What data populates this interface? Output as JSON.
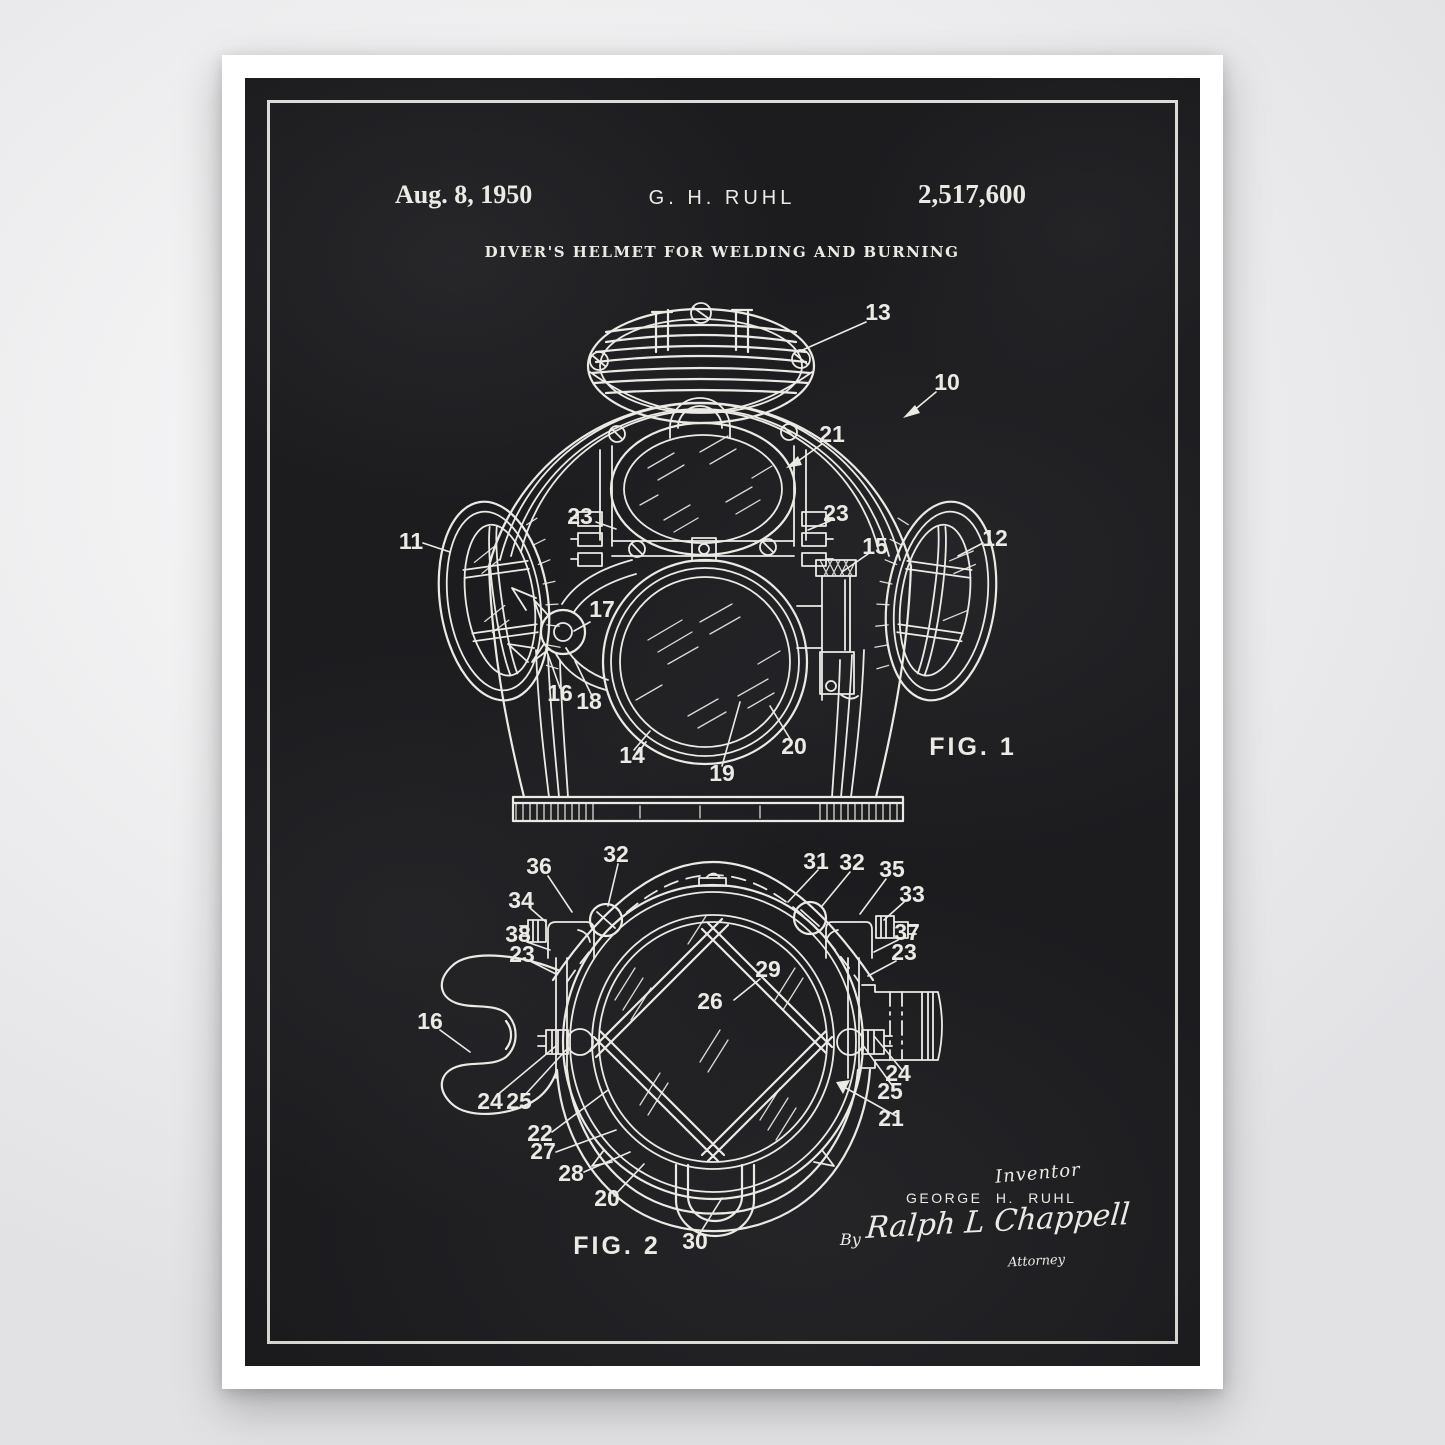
{
  "poster": {
    "colors": {
      "board": "#1c1c1f",
      "chalk_line": "#eceae5",
      "paper": "#ffffff",
      "page_background": "#ececee"
    },
    "header": {
      "date": "Aug. 8, 1950",
      "inventor_initials": "G. H. RUHL",
      "patent_number": "2,517,600",
      "title": "DIVER'S HELMET FOR WELDING AND BURNING"
    },
    "figure1": {
      "caption": "FIG. 1",
      "callouts": [
        {
          "label": "13"
        },
        {
          "label": "10"
        },
        {
          "label": "21"
        },
        {
          "label": "23"
        },
        {
          "label": "23"
        },
        {
          "label": "15"
        },
        {
          "label": "11"
        },
        {
          "label": "12"
        },
        {
          "label": "17"
        },
        {
          "label": "16"
        },
        {
          "label": "18"
        },
        {
          "label": "14"
        },
        {
          "label": "19"
        },
        {
          "label": "20"
        }
      ]
    },
    "figure2": {
      "caption": "FIG. 2",
      "callouts": [
        {
          "label": "36"
        },
        {
          "label": "32"
        },
        {
          "label": "31"
        },
        {
          "label": "32"
        },
        {
          "label": "35"
        },
        {
          "label": "34"
        },
        {
          "label": "33"
        },
        {
          "label": "38"
        },
        {
          "label": "37"
        },
        {
          "label": "23"
        },
        {
          "label": "23"
        },
        {
          "label": "29"
        },
        {
          "label": "26"
        },
        {
          "label": "16"
        },
        {
          "label": "24"
        },
        {
          "label": "25"
        },
        {
          "label": "24"
        },
        {
          "label": "25"
        },
        {
          "label": "21"
        },
        {
          "label": "22"
        },
        {
          "label": "27"
        },
        {
          "label": "28"
        },
        {
          "label": "20"
        },
        {
          "label": "30"
        }
      ]
    },
    "signature": {
      "inventor_label": "Inventor",
      "inventor_name": "GEORGE H. RUHL",
      "by_label": "By",
      "attorney_signature": "Ralph L Chappell",
      "attorney_label": "Attorney"
    }
  }
}
